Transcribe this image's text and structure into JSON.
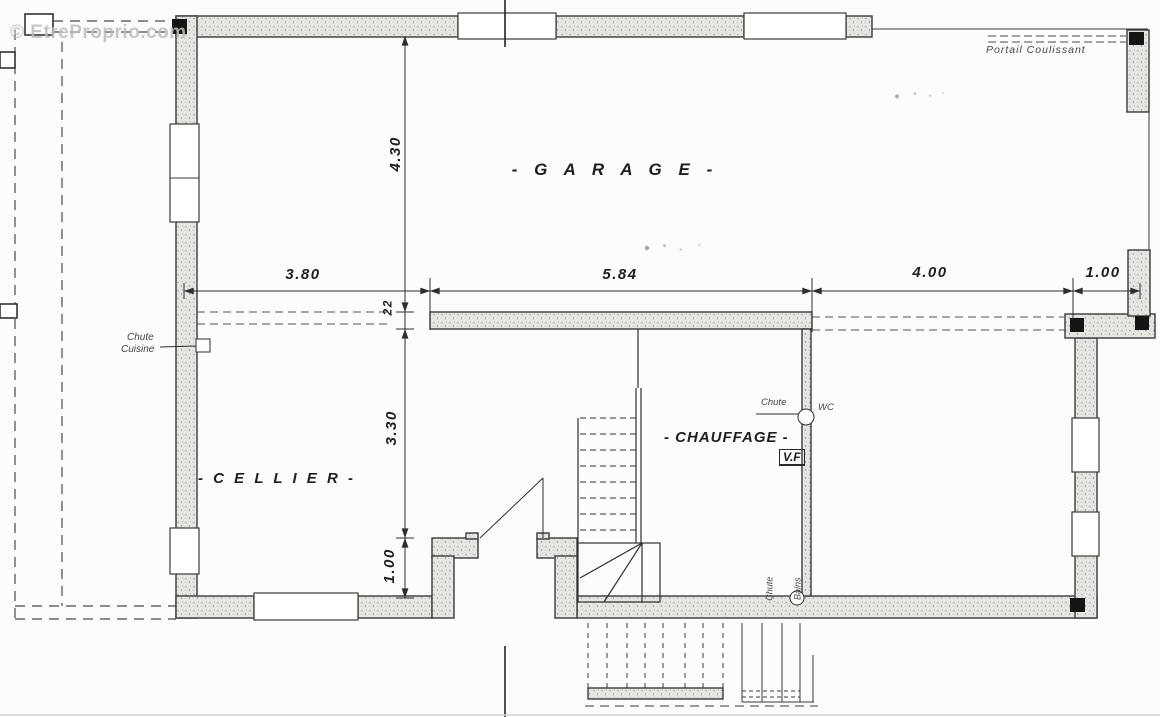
{
  "watermark": "© EtreProprio.com",
  "rooms": {
    "garage": "- G A R A G E -",
    "cellier": "- C E L L I E R -",
    "chauffage": "- CHAUFFAGE -"
  },
  "dimensions": {
    "width_cellier": "3.80",
    "width_middle": "5.84",
    "width_right": "4.00",
    "width_offset": "1.00",
    "depth_garage": "4.30",
    "wall_thickness": "22",
    "depth_cellier": "3.30",
    "depth_entry": "1.00"
  },
  "annotations": {
    "portail_coulissant": "Portail Coulissant",
    "chute_cuisine_line1": "Chute",
    "chute_cuisine_line2": "Cuisine",
    "chute_wc_label": "Chute",
    "wc_label": "WC",
    "vf_label": "V.F",
    "chute_bains_line1": "Chute",
    "chute_bains_line2": "Bains"
  }
}
